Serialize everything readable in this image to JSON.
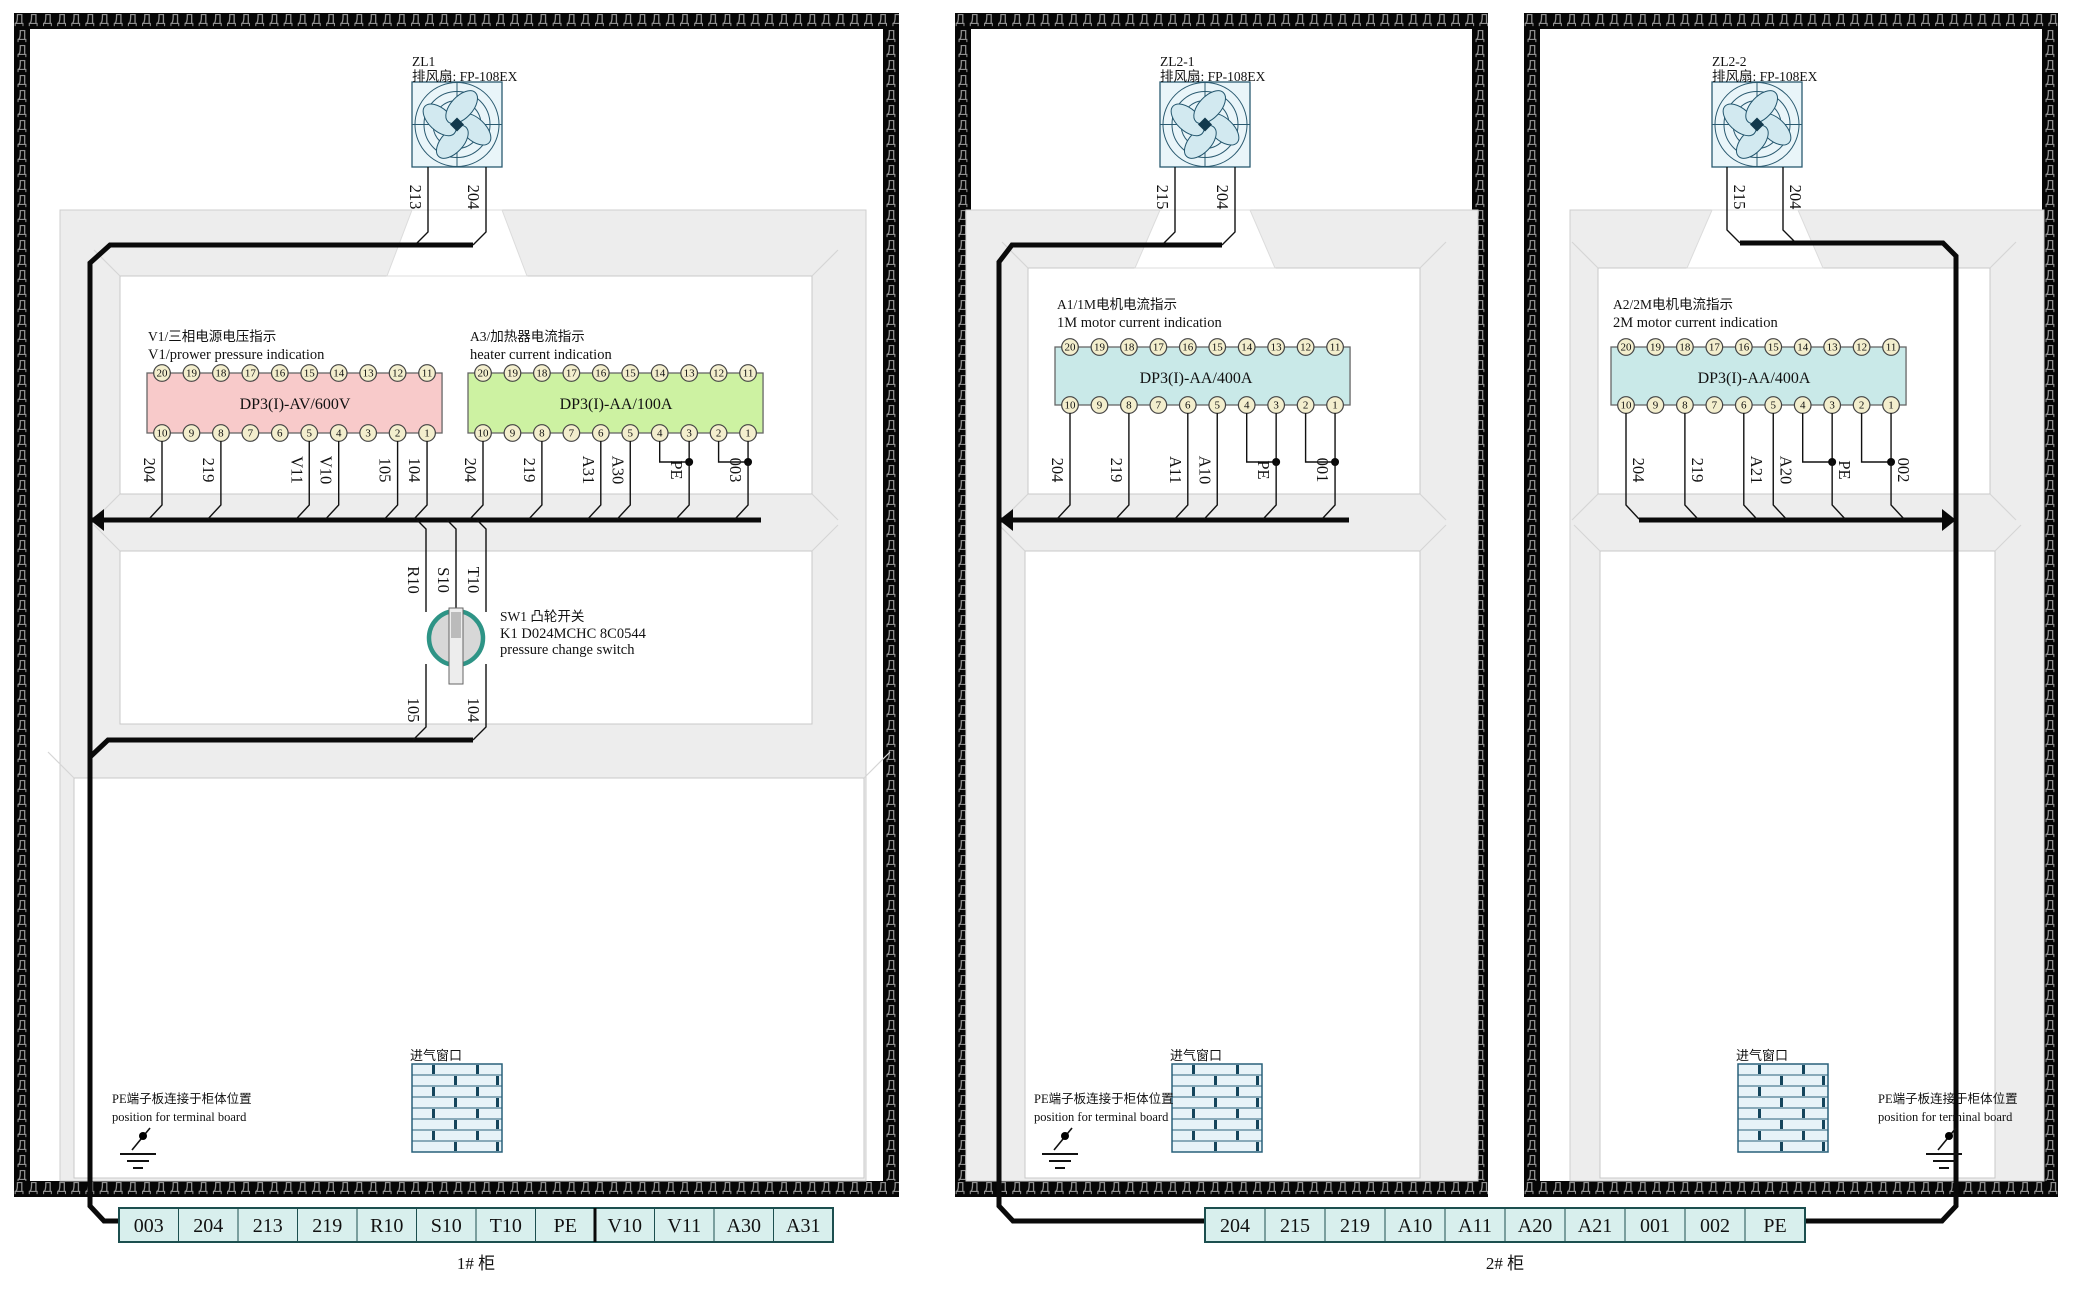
{
  "hatch_glyph": "Д",
  "terminal_numbers_top": [
    "20",
    "19",
    "18",
    "17",
    "16",
    "15",
    "14",
    "13",
    "12",
    "11"
  ],
  "terminal_numbers_bottom": [
    "10",
    "9",
    "8",
    "7",
    "6",
    "5",
    "4",
    "3",
    "2",
    "1"
  ],
  "cabinets": [
    {
      "name": "1# cabinet",
      "fan": {
        "tag": "ZL1",
        "label": "排风扇: FP-108EX",
        "wires": [
          "213",
          "204"
        ]
      },
      "meters": [
        {
          "title_zh": "V1/三相电源电压指示",
          "title_en": "V1/prower pressure indication",
          "model": "DP3(I)-AV/600V",
          "color": "#f8caca",
          "wires": [
            {
              "label": "204",
              "terminal": 10
            },
            {
              "label": "219",
              "terminal": 8
            },
            {
              "label": "V11",
              "terminal": 5
            },
            {
              "label": "V10",
              "terminal": 4
            },
            {
              "label": "105",
              "terminal": 2
            },
            {
              "label": "104",
              "terminal": 1
            }
          ]
        },
        {
          "title_zh": "A3/加热器电流指示",
          "title_en": "heater current indication",
          "model": "DP3(I)-AA/100A",
          "color": "#cdf2a2",
          "wires": [
            {
              "label": "204",
              "terminal": 10
            },
            {
              "label": "219",
              "terminal": 8
            },
            {
              "label": "A31",
              "terminal": 6
            },
            {
              "label": "A30",
              "terminal": 5
            },
            {
              "label": "PE",
              "terminal": 3,
              "bridge_terminal": 4
            },
            {
              "label": "003",
              "terminal": 1,
              "bridge_terminal": 2
            }
          ]
        }
      ],
      "switch": {
        "line1": "SW1 凸轮开关",
        "line2": "K1 D024MCHC 8C0544",
        "line3": "pressure change switch",
        "top_wires": [
          "R10",
          "S10",
          "T10"
        ],
        "bottom_wires": [
          "105",
          "104"
        ]
      },
      "pe_note": {
        "line1": "PE端子板连接于柜体位置",
        "line2": "position for terminal board"
      },
      "vent_label": "进气窗口"
    },
    {
      "name": "2# cabinet left section",
      "fan": {
        "tag": "ZL2-1",
        "label": "排风扇: FP-108EX",
        "wires": [
          "215",
          "204"
        ]
      },
      "meters": [
        {
          "title_zh": "A1/1M电机电流指示",
          "title_en": "1M motor current indication",
          "model": "DP3(I)-AA/400A",
          "color": "#c9e9e8",
          "wires": [
            {
              "label": "204",
              "terminal": 10
            },
            {
              "label": "219",
              "terminal": 8
            },
            {
              "label": "A11",
              "terminal": 6
            },
            {
              "label": "A10",
              "terminal": 5
            },
            {
              "label": "PE",
              "terminal": 3,
              "bridge_terminal": 4
            },
            {
              "label": "001",
              "terminal": 1,
              "bridge_terminal": 2
            }
          ]
        }
      ],
      "pe_note": {
        "line1": "PE端子板连接于柜体位置",
        "line2": "position for terminal board"
      },
      "vent_label": "进气窗口"
    },
    {
      "name": "2# cabinet right section",
      "fan": {
        "tag": "ZL2-2",
        "label": "排风扇: FP-108EX",
        "wires": [
          "215",
          "204"
        ]
      },
      "meters": [
        {
          "title_zh": "A2/2M电机电流指示",
          "title_en": "2M motor current indication",
          "model": "DP3(I)-AA/400A",
          "color": "#c9e9e8",
          "wires": [
            {
              "label": "204",
              "terminal": 10
            },
            {
              "label": "219",
              "terminal": 8
            },
            {
              "label": "A21",
              "terminal": 6
            },
            {
              "label": "A20",
              "terminal": 5
            },
            {
              "label": "PE",
              "terminal": 3,
              "bridge_terminal": 4
            },
            {
              "label": "002",
              "terminal": 1,
              "bridge_terminal": 2
            }
          ]
        }
      ],
      "pe_note": {
        "line1": "PE端子板连接于柜体位置",
        "line2": "position for terminal board"
      },
      "vent_label": "进气窗口"
    }
  ],
  "strips": [
    {
      "caption": "1# 柜",
      "cells": [
        "003",
        "204",
        "213",
        "219",
        "R10",
        "S10",
        "T10",
        "PE",
        "V10",
        "V11",
        "A30",
        "A31"
      ]
    },
    {
      "caption": "2# 柜",
      "cells": [
        "204",
        "215",
        "219",
        "A10",
        "A11",
        "A20",
        "A21",
        "001",
        "002",
        "PE"
      ]
    }
  ]
}
